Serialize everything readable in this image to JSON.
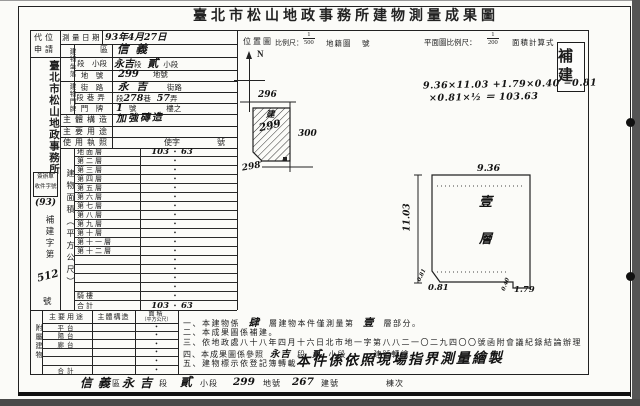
{
  "document": {
    "title": "臺北市松山地政事務所建物測量成果圖",
    "stamp": "補建"
  },
  "header": {
    "applicant_line1": "代位",
    "applicant_line2": "申請",
    "survey_date_label": "測量日期",
    "survey_date_value": "93年4月27日",
    "location_map_title": "位置圖",
    "scale_label": "比例尺：",
    "scale1_num": "1",
    "scale1_den": "500",
    "cadastral_label": "地籍圖",
    "sheet_no_label": "號",
    "north_label": "N",
    "plan_scale_label": "平面圖比例尺：",
    "scale2_num": "1",
    "scale2_den": "200",
    "area_calc_label": "面積計算式"
  },
  "sidebar": {
    "office_name": "臺北市松山地政事務所",
    "receipt_line1": "簽辦單",
    "receipt_line2": "收件字號",
    "receipt_year": "(93)",
    "case_prefix": "補建字第",
    "case_number": "512",
    "case_suffix": "號"
  },
  "form": {
    "location_group": "建物坐落",
    "door_group": "建物門牌",
    "district": {
      "label": "區",
      "value": "信義"
    },
    "section": {
      "label": "段　小段",
      "hw1": "永吉",
      "mid": "段",
      "hw2": "貳",
      "suffix": "小段"
    },
    "parcel": {
      "label": "地　號",
      "value": "299",
      "suffix": "地號"
    },
    "street": {
      "label": "街　路",
      "value": "永吉",
      "suffix": "街路"
    },
    "lane": {
      "label": "段巷弄",
      "p1": "段",
      "hw1": "278",
      "p2": "巷",
      "hw2": "57",
      "p3": "弄"
    },
    "door": {
      "label": "門　牌",
      "value": "1",
      "suffix1": "號",
      "suffix2": "樓之"
    },
    "structure": {
      "label": "主體構造",
      "value": "加強磚造"
    },
    "usage": {
      "label": "主要用途",
      "value": ""
    },
    "license": {
      "label": "使用執照",
      "value": "使字",
      "suffix": "號"
    }
  },
  "floors": {
    "group_label": "建物面積（平方公尺）",
    "dot": "•",
    "rows": [
      {
        "label": "地面層",
        "left": "103",
        "right": "63"
      },
      {
        "label": "第二層",
        "left": "",
        "right": ""
      },
      {
        "label": "第三層",
        "left": "",
        "right": ""
      },
      {
        "label": "第四層",
        "left": "",
        "right": ""
      },
      {
        "label": "第五層",
        "left": "",
        "right": ""
      },
      {
        "label": "第六層",
        "left": "",
        "right": ""
      },
      {
        "label": "第七層",
        "left": "",
        "right": ""
      },
      {
        "label": "第八層",
        "left": "",
        "right": ""
      },
      {
        "label": "第九層",
        "left": "",
        "right": ""
      },
      {
        "label": "第十層",
        "left": "",
        "right": ""
      },
      {
        "label": "第十一層",
        "left": "",
        "right": ""
      },
      {
        "label": "第十二層",
        "left": "",
        "right": ""
      },
      {
        "label": "",
        "left": "",
        "right": ""
      },
      {
        "label": "",
        "left": "",
        "right": ""
      },
      {
        "label": "",
        "left": "",
        "right": ""
      },
      {
        "label": "",
        "left": "",
        "right": ""
      },
      {
        "label": "騎樓",
        "left": "",
        "right": ""
      },
      {
        "label": "合計",
        "left": "103",
        "right": "63"
      }
    ]
  },
  "attached": {
    "group_label": "附屬建物",
    "col_use": "主要用途",
    "col_structure": "主體構造",
    "col_area_1": "面積",
    "col_area_2": "（平方公尺）",
    "dot": "•",
    "rows": [
      {
        "use": "平台"
      },
      {
        "use": "陽台"
      },
      {
        "use": "廊台"
      },
      {
        "use": ""
      },
      {
        "use": ""
      },
      {
        "use": "合計"
      }
    ]
  },
  "notes": {
    "n1": [
      "一、本建物係",
      "肆",
      "層建物本件僅測量第",
      "壹",
      "層部分。"
    ],
    "n2": "二、本成果圖係補建。",
    "n3": "三、依地政處八十八年四月十六日北市地一字第八八二一〇二九四〇〇號函附會議紀錄結論辦理",
    "n4": [
      "四、本成果圖係參照",
      "永吉",
      "段",
      "貳",
      "小段",
      "建號轉繪。"
    ],
    "n5": "五、建物標示依登記簿轉載",
    "n5_stamp": "本件係依照現場指界測量繪製"
  },
  "bottom_bar": {
    "district_value": "信義",
    "district_label": "區",
    "section_value": "永吉",
    "section_label": "段",
    "subsection_value": "貳",
    "subsection_label": "小段",
    "parcel_value": "299",
    "parcel_label": "地號",
    "building_value": "267",
    "building_label": "建號",
    "unit_label": "棟次"
  },
  "location_map": {
    "parcel_top": "296",
    "parcel_right": "300",
    "parcel_bottom": "298",
    "building_mark": "建",
    "parcel_no": "299"
  },
  "plan": {
    "formula_line1": "9.36×11.03 +1.79×0.40 −0.81",
    "formula_line2": "×0.81×½ ＝ 103.63",
    "dim_top": "9.36",
    "dim_left": "11.03",
    "dim_chamfer_side": "0.81",
    "dim_chamfer": "0.81",
    "dim_notch_h": "0.40",
    "dim_notch_w": "1.79",
    "room_char1": "壹",
    "room_char2": "層"
  }
}
